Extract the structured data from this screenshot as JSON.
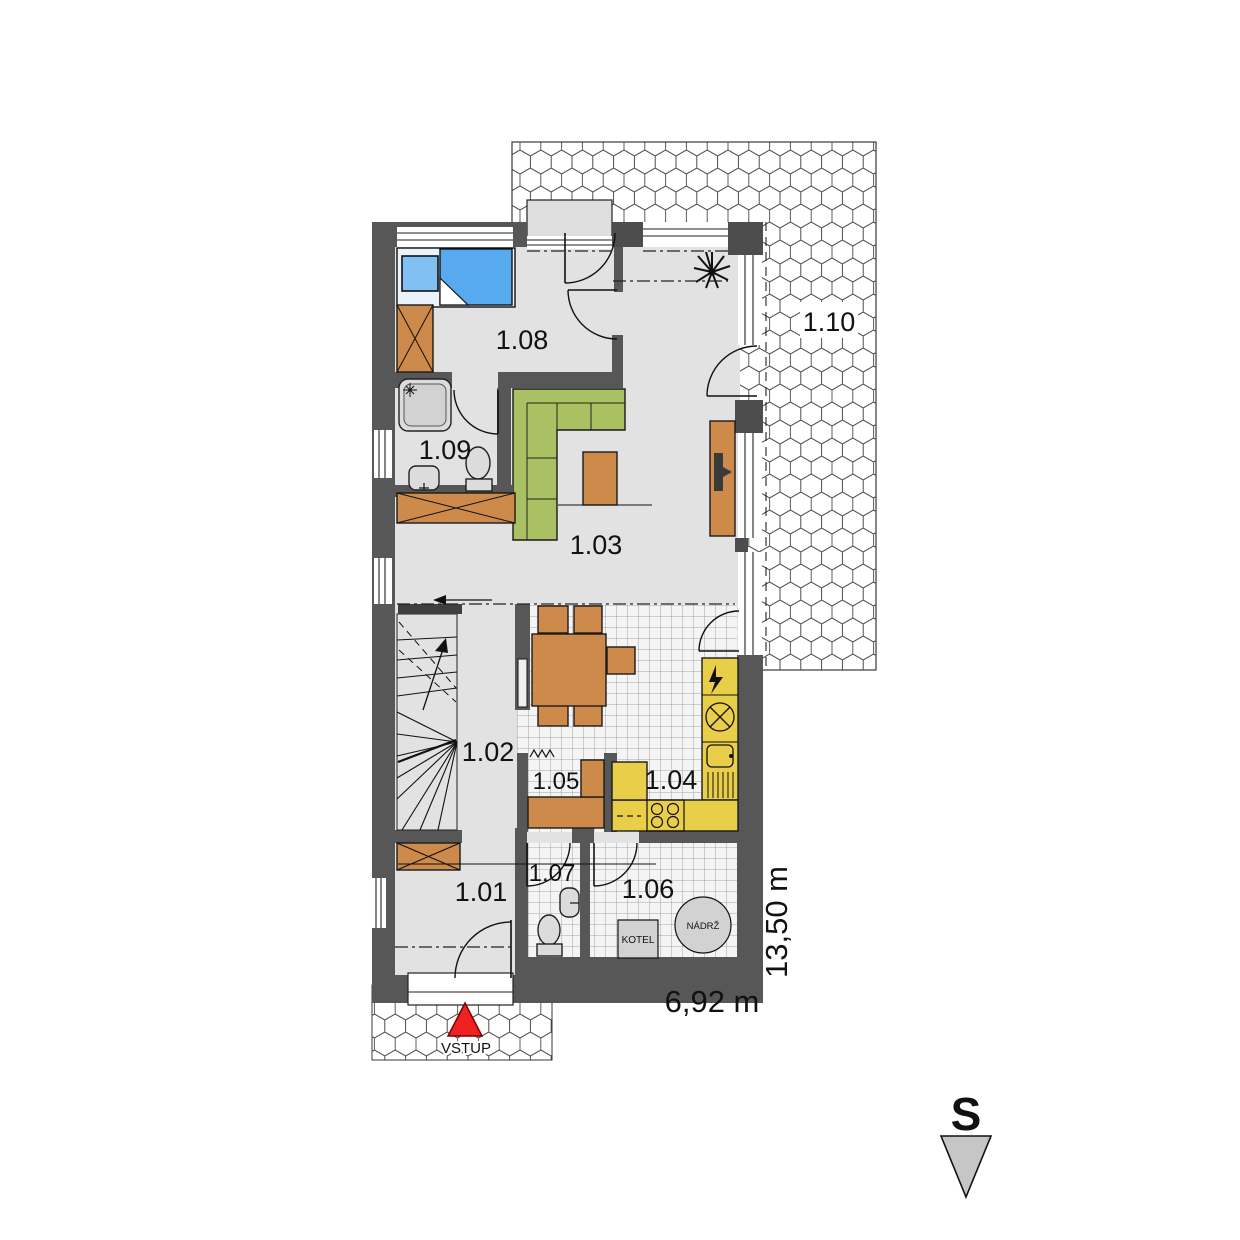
{
  "plan": {
    "rooms": [
      {
        "number": "1.01"
      },
      {
        "number": "1.02"
      },
      {
        "number": "1.03"
      },
      {
        "number": "1.04"
      },
      {
        "number": "1.05"
      },
      {
        "number": "1.06"
      },
      {
        "number": "1.07"
      },
      {
        "number": "1.08"
      },
      {
        "number": "1.09"
      },
      {
        "number": "1.10"
      }
    ],
    "equipment": {
      "boiler": "KOTEL",
      "tank": "NÁDRŽ"
    },
    "entrance_label": "VSTUP",
    "north_label": "S",
    "dimensions": {
      "width": "6,92 m",
      "depth": "13,50 m"
    },
    "colors": {
      "wall": "#575757",
      "floor": "#e2e2e2",
      "wood_furniture": "#cd8a4a",
      "sofa": "#a9c163",
      "kitchen_units": "#e9ce4a",
      "bed": "#58aaee",
      "entrance_arrow": "#ee2222",
      "north_triangle": "#c6c6c6"
    }
  }
}
